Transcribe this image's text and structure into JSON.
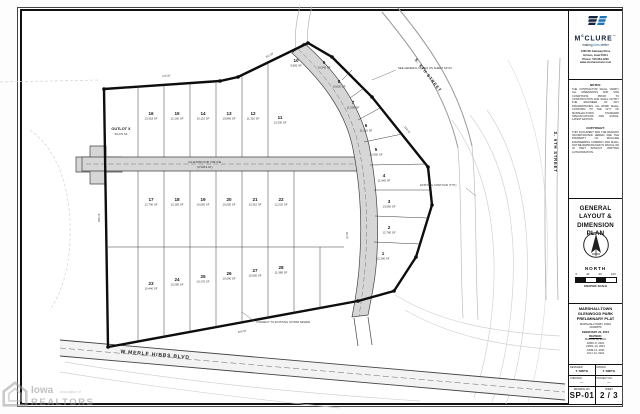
{
  "watermark": {
    "brand_top": "Iowa",
    "brand_small": "Association of",
    "brand_bottom": "REALTORS"
  },
  "drawing": {
    "streets": {
      "merle_hibbs": "W MERLE HIBBS BLVD",
      "sixth_top": "S. 6TH STREET",
      "sixth_right": "S. 6TH STREET",
      "center_name": "GLENWOOD DRIVE",
      "center_sub": "(PUBLIC)"
    },
    "outlot": {
      "label": "OUTLOT X",
      "area": "36,270 SF"
    },
    "callouts": {
      "a": "SEE GENERAL NOTES ON SHEET SP-03",
      "b": "CONNECT TO EXISTING STORM SEWER",
      "c": "EXISTING CONTOUR (TYP.)"
    },
    "dims": {
      "d0": "125.00'",
      "d1": "264.15'",
      "d2": "312.55'",
      "d3": "118.42'",
      "d4": "289.30'",
      "d5": "60.00'"
    },
    "lots": [
      {
        "num": "1",
        "area": "12,390 SF"
      },
      {
        "num": "2",
        "area": "12,780 SF"
      },
      {
        "num": "3",
        "area": "13,060 SF"
      },
      {
        "num": "4",
        "area": "11,640 SF"
      },
      {
        "num": "5",
        "area": "12,060 SF"
      },
      {
        "num": "6",
        "area": "11,210 SF"
      },
      {
        "num": "7",
        "area": "11,000 SF"
      },
      {
        "num": "8",
        "area": "10,820 SF"
      },
      {
        "num": "9",
        "area": "10,540 SF"
      },
      {
        "num": "10",
        "area": "9,980 SF"
      },
      {
        "num": "11",
        "area": "13,330 SF"
      },
      {
        "num": "12",
        "area": "11,310 SF"
      },
      {
        "num": "13",
        "area": "10,860 SF"
      },
      {
        "num": "14",
        "area": "10,110 SF"
      },
      {
        "num": "15",
        "area": "12,150 SF"
      },
      {
        "num": "16",
        "area": "13,318 SF"
      },
      {
        "num": "17",
        "area": "12,790 SF"
      },
      {
        "num": "18",
        "area": "10,150 SF"
      },
      {
        "num": "19",
        "area": "10,060 SF"
      },
      {
        "num": "20",
        "area": "10,000 SF"
      },
      {
        "num": "21",
        "area": "10,310 SF"
      },
      {
        "num": "22",
        "area": "12,220 SF"
      },
      {
        "num": "23",
        "area": "10,440 SF"
      },
      {
        "num": "24",
        "area": "10,280 SF"
      },
      {
        "num": "25",
        "area": "10,170 SF"
      },
      {
        "num": "26",
        "area": "10,090 SF"
      },
      {
        "num": "27",
        "area": "10,650 SF"
      },
      {
        "num": "28",
        "area": "11,980 SF"
      }
    ]
  },
  "title_block": {
    "logo": {
      "m": "M",
      "c": "c",
      "rest": "CLURE",
      "tm": "™",
      "tag1": "making",
      "tag2": "lives",
      "tag3": "better",
      "address": [
        "1360 SE Gateway Drive",
        "Grimes, Iowa 50111",
        "Phone: 515.964.1229",
        "www.mcclurevision.com"
      ]
    },
    "notes_heading": "NOTES:",
    "notes_body": "THE CONTRACTOR SHALL VERIFY ALL DIMENSIONS AND SITE CONDITIONS PRIOR TO CONSTRUCTION AND SHALL NOTIFY THE ENGINEER OF ANY DISCREPANCIES. ALL WORK SHALL CONFORM TO THE CITY OF MARSHALLTOWN STANDARD SPECIFICATIONS AND SUDAS, LATEST EDITION.",
    "copyright_heading": "COPYRIGHT:",
    "copyright_body": "THIS DOCUMENT AND THE DESIGNS INCORPORATED HEREIN ARE THE PROPERTY OF McCLURE ENGINEERING COMPANY AND SHALL NOT BE REPRODUCED IN WHOLE OR IN PART WITHOUT WRITTEN AUTHORIZATION.",
    "plan_title_1": "GENERAL LAYOUT &",
    "plan_title_2": "DIMENSION PLAN",
    "north_label": "NORTH",
    "scale_ticks": [
      "0",
      "30",
      "60",
      "120"
    ],
    "scale_label": "GRAPHIC SCALE",
    "project": {
      "city": "MARSHALLTOWN",
      "name": "GLENWOOD PARK",
      "doc": "PRELIMINARY PLAT",
      "location": "MARSHALLTOWN, IOWA",
      "project_no": "20190876",
      "date": "FEBRUARY 24, 2021",
      "revised_heading": "REVISED:",
      "revisions": [
        "MARCH 18, 2021",
        "APRIL 8, 2021",
        "APRIL 13, 2021",
        "JUNE 14, 2021",
        "JULY 12, 2021"
      ]
    },
    "credits": {
      "designed_label": "DESIGNED:",
      "designed": "T. SMITH",
      "drawn_label": "DRAWN:",
      "drawn": "T. SMITH",
      "checked_label": "CHECKED:",
      "checked": "—",
      "project_no_label": "PROJECT NO:",
      "project_no": "—"
    },
    "sheet": {
      "drawing_no_label": "DRAWING NO.",
      "drawing_no": "SP-01",
      "sheet_label": "SHEET",
      "sheet_current": "2",
      "sheet_sep": "/",
      "sheet_total": "3"
    }
  }
}
